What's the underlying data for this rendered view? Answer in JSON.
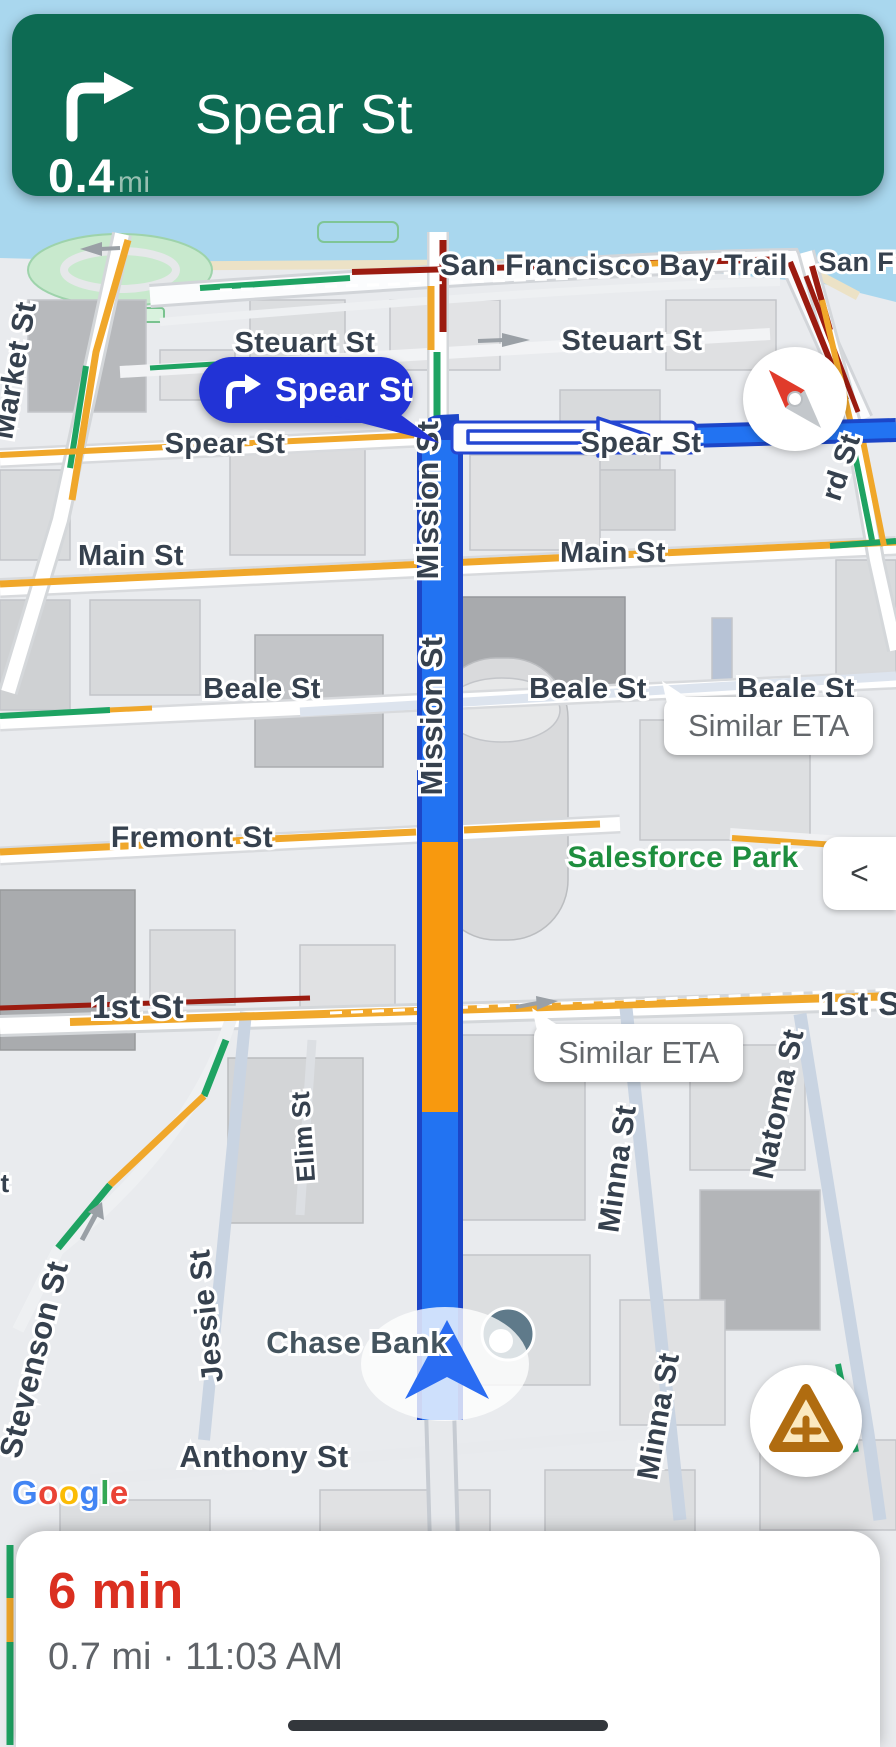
{
  "app": {
    "name": "Google Maps navigation"
  },
  "nav_banner": {
    "distance": "0.4",
    "unit": "mi",
    "instruction": "Spear St",
    "bg_color": "#0d6b53",
    "maneuver": "turn-right"
  },
  "maneuver_callout": {
    "label": "Spear St",
    "bg_color": "#2233d6",
    "maneuver": "turn-right"
  },
  "eta_bubbles": [
    {
      "text": "Similar ETA"
    },
    {
      "text": "Similar ETA"
    }
  ],
  "buttons": {
    "panel_toggle": "<"
  },
  "bottom_sheet": {
    "eta": "6 min",
    "details": "0.7 mi · 11:03 AM"
  },
  "attribution": {
    "text": "Google",
    "letters": [
      "G",
      "o",
      "o",
      "g",
      "l",
      "e"
    ],
    "letter_colors": [
      "#4285F4",
      "#EA4335",
      "#FBBC05",
      "#4285F4",
      "#34A853",
      "#EA4335"
    ]
  },
  "map_labels": {
    "bay_trail": "San Francisco Bay Trail",
    "san_fran": "San Fran",
    "market_st": "Market St",
    "steuart_st_left": "Steuart St",
    "steuart_st_right": "Steuart St",
    "spear_st_left": "Spear St",
    "spear_st_right": "Spear St",
    "main_st_left": "Main St",
    "main_st_right": "Main St",
    "beale_st_left": "Beale St",
    "beale_st_mid": "Beale St",
    "beale_st_right": "Beale St",
    "fremont_st": "Fremont St",
    "salesforce_park": "Salesforce Park",
    "first_st_left": "1st St",
    "first_st_right": "1st St",
    "mission_st_1": "Mission St",
    "mission_st_2": "Mission St",
    "natoma_st": "Natoma St",
    "minna_st_1": "Minna St",
    "minna_st_2": "Minna St",
    "elim_st": "Elim St",
    "jessie_st": "Jessie St",
    "stevenson_st": "Stevenson St",
    "anthony_st": "Anthony St",
    "rd_st": "rd St",
    "t_partial": "t",
    "chase_bank": "Chase Bank"
  },
  "route": {
    "current_street": "Mission St",
    "next_street": "Spear St",
    "route_color": "#2273f2",
    "route_border_color": "#1c46c8",
    "slow_traffic_color": "#f8990e"
  },
  "traffic_colors": {
    "heavy": "#9b1b10",
    "medium": "#f0a72a",
    "light": "#1ea362"
  },
  "theme_colors": {
    "water": "#a9d7ee",
    "banner_green": "#0d6b53",
    "callout_blue": "#2233d6",
    "eta_red": "#da2f20",
    "detail_gray": "#5f6368",
    "street_label": "#36414e",
    "park_label_green": "#1e8e3e"
  },
  "icons": {
    "banner": "turn-right-icon",
    "callout": "turn-right-icon",
    "compass": "compass-icon",
    "panel_toggle": "chevron-left-icon",
    "report": "report-incident-icon",
    "location": "navigation-arrow-icon",
    "home": "home-indicator"
  }
}
